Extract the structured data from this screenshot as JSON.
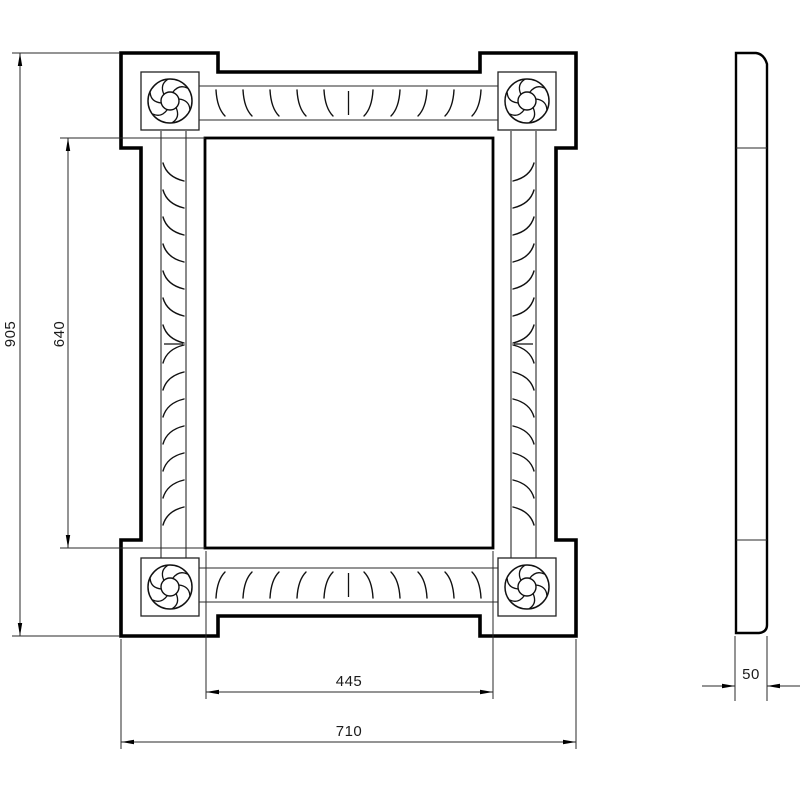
{
  "drawing": {
    "background": "#ffffff",
    "stroke_color": "#000000",
    "thin_color": "#2a2a2a",
    "views": {
      "front": {
        "label": "front-view",
        "outline": [
          [
            121,
            53
          ],
          [
            218,
            53
          ],
          [
            218,
            72
          ],
          [
            480,
            72
          ],
          [
            480,
            53
          ],
          [
            576,
            53
          ],
          [
            576,
            148
          ],
          [
            556,
            148
          ],
          [
            556,
            540
          ],
          [
            576,
            540
          ],
          [
            576,
            636
          ],
          [
            480,
            636
          ],
          [
            480,
            616
          ],
          [
            218,
            616
          ],
          [
            218,
            636
          ],
          [
            121,
            636
          ],
          [
            121,
            540
          ],
          [
            141,
            540
          ],
          [
            141,
            148
          ],
          [
            121,
            148
          ]
        ],
        "mirror_rect": [
          205,
          138,
          493,
          548
        ],
        "corner_squares": [
          [
            141,
            72,
            199,
            130
          ],
          [
            498,
            72,
            556,
            130
          ],
          [
            141,
            558,
            199,
            616
          ],
          [
            498,
            558,
            556,
            616
          ]
        ],
        "rosettes": {
          "centers": [
            [
              170,
              101
            ],
            [
              527,
              101
            ],
            [
              170,
              587
            ],
            [
              527,
              587
            ]
          ],
          "outer_r": 22,
          "inner_r": 9,
          "petal_count": 6
        },
        "bands": {
          "horizontal": [
            {
              "x1": 199,
              "x2": 498,
              "y_top": 86,
              "y_bottom": 120,
              "center_x": 348.5,
              "hatch_count_per_side": 5,
              "hatch_spacing": 27,
              "hatch_start_x": 216,
              "flip": false
            },
            {
              "x1": 199,
              "x2": 498,
              "y_top": 568,
              "y_bottom": 602,
              "center_x": 348.5,
              "hatch_count_per_side": 5,
              "hatch_spacing": 27,
              "hatch_start_x": 216,
              "flip": true
            }
          ],
          "vertical": [
            {
              "y1": 131,
              "y2": 558,
              "x_left": 161,
              "x_right": 186,
              "center_y": 344,
              "hatch_count_per_side": 7,
              "hatch_spacing": 27,
              "hatch_start_y": 163,
              "flip": false
            },
            {
              "y1": 131,
              "y2": 558,
              "x_left": 511,
              "x_right": 536,
              "center_y": 344,
              "hatch_count_per_side": 7,
              "hatch_spacing": 27,
              "hatch_start_y": 163,
              "flip": true
            }
          ]
        }
      },
      "side": {
        "label": "side-view",
        "x1": 736,
        "y1": 53,
        "x2": 767,
        "y2": 633,
        "chamfer": 11,
        "corner_radius": 8,
        "division_lines_y": [
          148,
          540
        ]
      }
    },
    "dimensions": [
      {
        "id": "overall-height",
        "label": "905",
        "orientation": "vertical",
        "line_x": 20,
        "from": 53,
        "to": 636,
        "ext": [
          [
            12,
            53,
            120,
            53
          ],
          [
            12,
            636,
            120,
            636
          ]
        ],
        "text": [
          15,
          334
        ]
      },
      {
        "id": "mirror-height",
        "label": "640",
        "orientation": "vertical",
        "line_x": 68,
        "from": 138,
        "to": 548,
        "ext": [
          [
            60,
            138,
            205,
            138
          ],
          [
            60,
            548,
            205,
            548
          ]
        ],
        "text": [
          64,
          334
        ]
      },
      {
        "id": "mirror-width",
        "label": "445",
        "orientation": "horizontal",
        "line_y": 692,
        "from": 206,
        "to": 493,
        "ext": [
          [
            206,
            551,
            206,
            699
          ],
          [
            493,
            551,
            493,
            699
          ]
        ],
        "text": [
          349,
          686
        ]
      },
      {
        "id": "overall-width",
        "label": "710",
        "orientation": "horizontal",
        "line_y": 742,
        "from": 121,
        "to": 576,
        "ext": [
          [
            121,
            639,
            121,
            749
          ],
          [
            576,
            639,
            576,
            749
          ]
        ],
        "text": [
          349,
          736
        ]
      },
      {
        "id": "depth",
        "label": "50",
        "orientation": "horizontal",
        "style": "outside",
        "line_y": 686,
        "from": 735,
        "to": 767,
        "outside_len": 33,
        "ext": [
          [
            735,
            636,
            735,
            701
          ],
          [
            767,
            636,
            767,
            701
          ]
        ],
        "text": [
          751,
          679
        ]
      }
    ]
  }
}
